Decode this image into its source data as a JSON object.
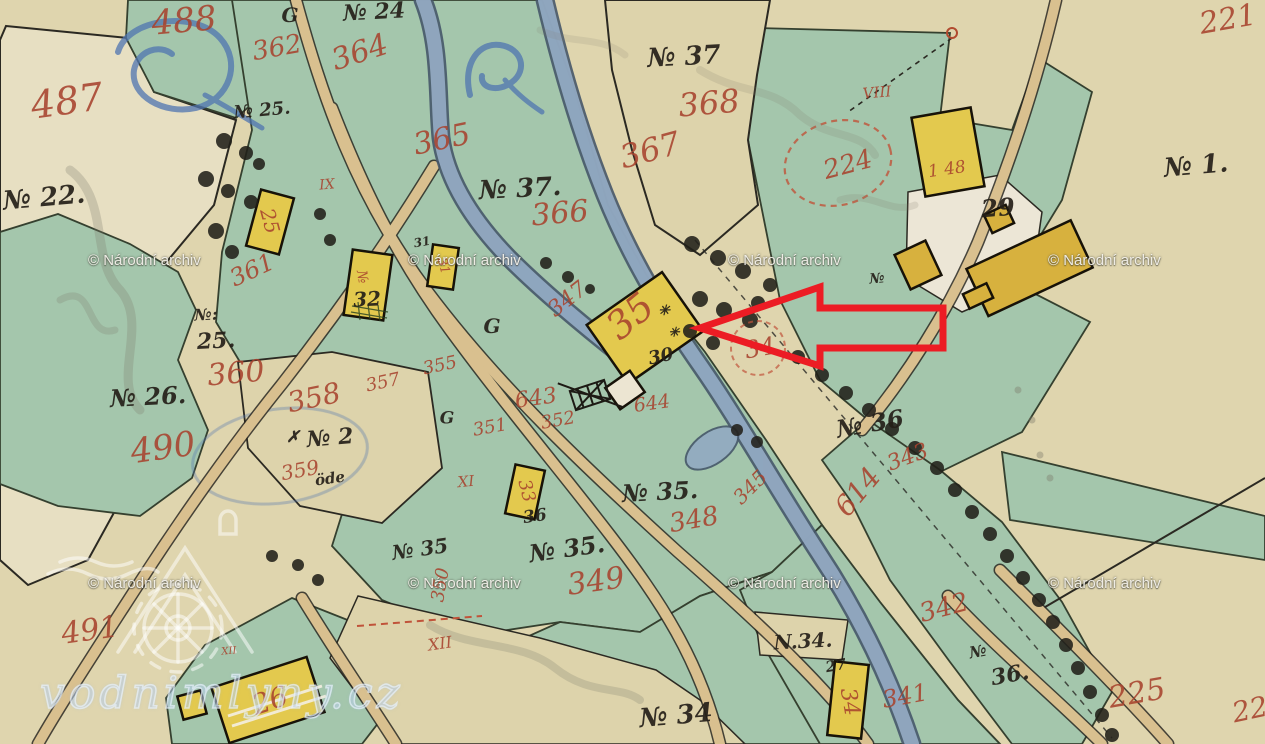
{
  "map": {
    "type": "historical cadastral map sheet",
    "description": "hand-drawn parcels with green meadows, yellow buildings, roads and a stream"
  },
  "colors": {
    "red_ink": "#a8432e",
    "black_ink": "#241f18",
    "arrow_red": "#ec1c24"
  },
  "watermarks": {
    "archive_text": "© Národní archiv",
    "site": "vodnimlyny.cz",
    "archive_positions": [
      {
        "x": 88,
        "y": 252
      },
      {
        "x": 408,
        "y": 252
      },
      {
        "x": 728,
        "y": 252
      },
      {
        "x": 1048,
        "y": 252
      },
      {
        "x": 88,
        "y": 575
      },
      {
        "x": 408,
        "y": 575
      },
      {
        "x": 728,
        "y": 575
      },
      {
        "x": 1048,
        "y": 575
      }
    ]
  },
  "annotation_arrow": {
    "points": "700,328 820,287 820,308 943,308 943,348 820,348 820,366",
    "color": "#ec1c24"
  },
  "labels": [
    {
      "text": "488",
      "x": 184,
      "y": 21,
      "size": 34,
      "color": "red",
      "rot": -5
    },
    {
      "text": "487",
      "x": 67,
      "y": 101,
      "size": 38,
      "color": "red",
      "rot": -8
    },
    {
      "text": "362",
      "x": 277,
      "y": 48,
      "size": 26,
      "color": "red",
      "rot": -10
    },
    {
      "text": "364",
      "x": 360,
      "y": 53,
      "size": 30,
      "color": "red",
      "rot": -18
    },
    {
      "text": "365",
      "x": 442,
      "y": 140,
      "size": 30,
      "color": "red",
      "rot": -12
    },
    {
      "text": "368",
      "x": 709,
      "y": 103,
      "size": 32,
      "color": "red",
      "rot": -5
    },
    {
      "text": "367",
      "x": 650,
      "y": 150,
      "size": 32,
      "color": "red",
      "rot": -15
    },
    {
      "text": "366",
      "x": 560,
      "y": 214,
      "size": 30,
      "color": "red",
      "rot": -5
    },
    {
      "text": "224",
      "x": 848,
      "y": 165,
      "size": 26,
      "color": "red",
      "rot": -15
    },
    {
      "text": "221",
      "x": 1228,
      "y": 20,
      "size": 30,
      "color": "red",
      "rot": -10
    },
    {
      "text": "1 48",
      "x": 947,
      "y": 170,
      "size": 17,
      "color": "red",
      "rot": -8
    },
    {
      "text": "VIII",
      "x": 877,
      "y": 93,
      "size": 15,
      "color": "red",
      "rot": -5
    },
    {
      "text": "IX",
      "x": 327,
      "y": 185,
      "size": 14,
      "color": "red",
      "rot": -5
    },
    {
      "text": "XI",
      "x": 466,
      "y": 482,
      "size": 15,
      "color": "red",
      "rot": -5
    },
    {
      "text": "XII",
      "x": 440,
      "y": 644,
      "size": 16,
      "color": "red",
      "rot": -8
    },
    {
      "text": "XII",
      "x": 229,
      "y": 652,
      "size": 10,
      "color": "red",
      "rot": -5
    },
    {
      "text": "361",
      "x": 252,
      "y": 270,
      "size": 24,
      "color": "red",
      "rot": -25
    },
    {
      "text": "360",
      "x": 236,
      "y": 374,
      "size": 30,
      "color": "red",
      "rot": -5
    },
    {
      "text": "490",
      "x": 163,
      "y": 448,
      "size": 34,
      "color": "red",
      "rot": -8
    },
    {
      "text": "358",
      "x": 314,
      "y": 398,
      "size": 28,
      "color": "red",
      "rot": -12
    },
    {
      "text": "357",
      "x": 383,
      "y": 383,
      "size": 18,
      "color": "red",
      "rot": -12
    },
    {
      "text": "355",
      "x": 440,
      "y": 366,
      "size": 18,
      "color": "red",
      "rot": -12
    },
    {
      "text": "359",
      "x": 300,
      "y": 470,
      "size": 20,
      "color": "red",
      "rot": -10
    },
    {
      "text": "347",
      "x": 568,
      "y": 300,
      "size": 22,
      "color": "red",
      "rot": -38
    },
    {
      "text": "35",
      "x": 630,
      "y": 316,
      "size": 38,
      "color": "red",
      "rot": -40
    },
    {
      "text": "25",
      "x": 270,
      "y": 221,
      "size": 20,
      "color": "red",
      "rot": 75
    },
    {
      "text": "№",
      "x": 362,
      "y": 277,
      "size": 14,
      "color": "red",
      "rot": 80
    },
    {
      "text": "31",
      "x": 443,
      "y": 266,
      "size": 13,
      "color": "red",
      "rot": 75
    },
    {
      "text": "33",
      "x": 526,
      "y": 491,
      "size": 18,
      "color": "red",
      "rot": 75
    },
    {
      "text": "34",
      "x": 760,
      "y": 348,
      "size": 24,
      "color": "red",
      "rot": -10
    },
    {
      "text": "34",
      "x": 849,
      "y": 702,
      "size": 22,
      "color": "red",
      "rot": 80
    },
    {
      "text": "26",
      "x": 270,
      "y": 701,
      "size": 28,
      "color": "red",
      "rot": -18
    },
    {
      "text": "643",
      "x": 536,
      "y": 399,
      "size": 22,
      "color": "red",
      "rot": -8
    },
    {
      "text": "644",
      "x": 652,
      "y": 404,
      "size": 19,
      "color": "red",
      "rot": -8
    },
    {
      "text": "352",
      "x": 558,
      "y": 421,
      "size": 18,
      "color": "red",
      "rot": -10
    },
    {
      "text": "351",
      "x": 490,
      "y": 428,
      "size": 18,
      "color": "red",
      "rot": -10
    },
    {
      "text": "614",
      "x": 858,
      "y": 492,
      "size": 28,
      "color": "red",
      "rot": -50
    },
    {
      "text": "345",
      "x": 750,
      "y": 487,
      "size": 20,
      "color": "red",
      "rot": -45
    },
    {
      "text": "348",
      "x": 694,
      "y": 520,
      "size": 26,
      "color": "red",
      "rot": -10
    },
    {
      "text": "343",
      "x": 908,
      "y": 458,
      "size": 22,
      "color": "red",
      "rot": -20
    },
    {
      "text": "349",
      "x": 596,
      "y": 582,
      "size": 30,
      "color": "red",
      "rot": -8
    },
    {
      "text": "350",
      "x": 441,
      "y": 585,
      "size": 18,
      "color": "red",
      "rot": -80
    },
    {
      "text": "342",
      "x": 944,
      "y": 608,
      "size": 26,
      "color": "red",
      "rot": -15
    },
    {
      "text": "341",
      "x": 905,
      "y": 696,
      "size": 24,
      "color": "red",
      "rot": -10
    },
    {
      "text": "225",
      "x": 1137,
      "y": 694,
      "size": 30,
      "color": "red",
      "rot": -10
    },
    {
      "text": "22",
      "x": 1250,
      "y": 710,
      "size": 28,
      "color": "red",
      "rot": -12
    },
    {
      "text": "491",
      "x": 90,
      "y": 631,
      "size": 30,
      "color": "red",
      "rot": -8
    },
    {
      "text": "№ 24",
      "x": 374,
      "y": 12,
      "size": 22,
      "color": "black",
      "rot": -3
    },
    {
      "text": "G",
      "x": 290,
      "y": 15,
      "size": 20,
      "color": "black",
      "rot": 0
    },
    {
      "text": "№ 37",
      "x": 684,
      "y": 57,
      "size": 26,
      "color": "black",
      "rot": -3
    },
    {
      "text": "№ 37.",
      "x": 520,
      "y": 189,
      "size": 26,
      "color": "black",
      "rot": -3
    },
    {
      "text": "№ 25.",
      "x": 262,
      "y": 111,
      "size": 18,
      "color": "black",
      "rot": -5
    },
    {
      "text": "№ 22.",
      "x": 44,
      "y": 198,
      "size": 26,
      "color": "black",
      "rot": -5
    },
    {
      "text": "№ 1.",
      "x": 1196,
      "y": 166,
      "size": 26,
      "color": "black",
      "rot": -5
    },
    {
      "text": "29",
      "x": 998,
      "y": 208,
      "size": 24,
      "color": "black",
      "rot": -5
    },
    {
      "text": "№:",
      "x": 206,
      "y": 315,
      "size": 16,
      "color": "black",
      "rot": -3
    },
    {
      "text": "25.",
      "x": 216,
      "y": 341,
      "size": 22,
      "color": "black",
      "rot": -3
    },
    {
      "text": "№ 26.",
      "x": 148,
      "y": 397,
      "size": 24,
      "color": "black",
      "rot": -3
    },
    {
      "text": "✗",
      "x": 293,
      "y": 437,
      "size": 16,
      "color": "black",
      "rot": 0
    },
    {
      "text": "№ 2",
      "x": 330,
      "y": 438,
      "size": 22,
      "color": "black",
      "rot": -5
    },
    {
      "text": "öde",
      "x": 330,
      "y": 479,
      "size": 15,
      "color": "black",
      "rot": -8
    },
    {
      "text": "G",
      "x": 492,
      "y": 326,
      "size": 20,
      "color": "black",
      "rot": 0
    },
    {
      "text": "G",
      "x": 447,
      "y": 419,
      "size": 17,
      "color": "black",
      "rot": 0
    },
    {
      "text": "32",
      "x": 367,
      "y": 299,
      "size": 20,
      "color": "black",
      "rot": -3
    },
    {
      "text": "31",
      "x": 422,
      "y": 242,
      "size": 12,
      "color": "black",
      "rot": -10
    },
    {
      "text": "30",
      "x": 661,
      "y": 357,
      "size": 18,
      "color": "black",
      "rot": -12
    },
    {
      "text": "✳",
      "x": 664,
      "y": 311,
      "size": 14,
      "color": "black",
      "rot": 0
    },
    {
      "text": "✳",
      "x": 674,
      "y": 333,
      "size": 13,
      "color": "black",
      "rot": 0
    },
    {
      "text": "№",
      "x": 877,
      "y": 279,
      "size": 14,
      "color": "black",
      "rot": -5
    },
    {
      "text": "36",
      "x": 535,
      "y": 517,
      "size": 17,
      "color": "black",
      "rot": -8
    },
    {
      "text": "№ 35.",
      "x": 660,
      "y": 492,
      "size": 24,
      "color": "black",
      "rot": -3
    },
    {
      "text": "№ 35.",
      "x": 567,
      "y": 549,
      "size": 24,
      "color": "black",
      "rot": -8
    },
    {
      "text": "№ 35",
      "x": 420,
      "y": 549,
      "size": 20,
      "color": "black",
      "rot": -8
    },
    {
      "text": "№ 36",
      "x": 870,
      "y": 424,
      "size": 24,
      "color": "black",
      "rot": -10
    },
    {
      "text": "№",
      "x": 978,
      "y": 652,
      "size": 16,
      "color": "black",
      "rot": -10
    },
    {
      "text": "36.",
      "x": 1010,
      "y": 675,
      "size": 22,
      "color": "black",
      "rot": -10
    },
    {
      "text": "N.34.",
      "x": 803,
      "y": 641,
      "size": 20,
      "color": "black",
      "rot": -3
    },
    {
      "text": "№ 34",
      "x": 676,
      "y": 716,
      "size": 26,
      "color": "black",
      "rot": -5
    },
    {
      "text": "27",
      "x": 836,
      "y": 666,
      "size": 15,
      "color": "black",
      "rot": -10
    }
  ]
}
